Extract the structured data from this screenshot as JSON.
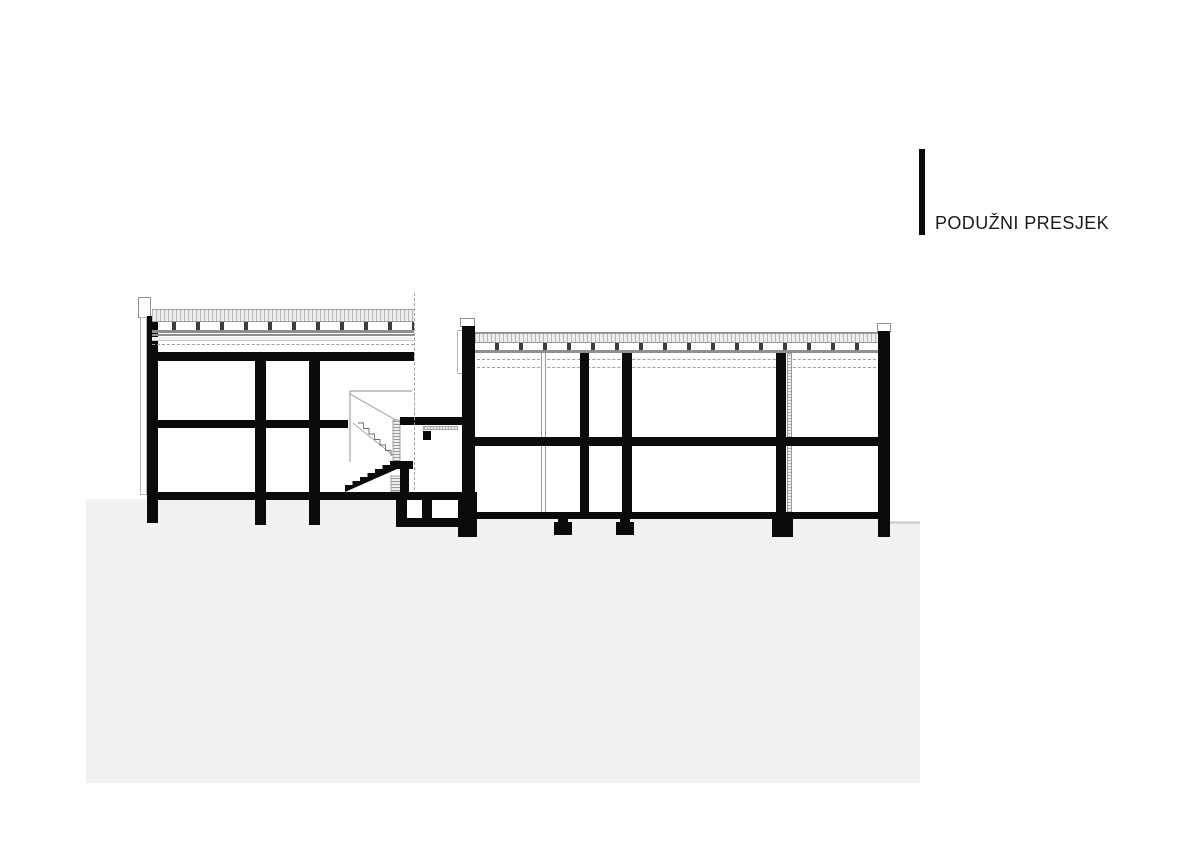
{
  "header": {
    "title": "PODUŽNI PRESJEK"
  },
  "drawing": {
    "label": "longitudinal-building-section",
    "parts": [
      "left-wing",
      "stair-core",
      "link-basement",
      "right-wing",
      "ground-mass"
    ],
    "colors": {
      "paper": "#ffffff",
      "structure": "#0b0b0b",
      "ground_fill": "#f1f1f1",
      "ground_edge": "#d6d6d6",
      "roof_hatch": "#b9b9b9",
      "dash_line": "#a0a0a0",
      "outline": "#8f8f8f"
    }
  }
}
